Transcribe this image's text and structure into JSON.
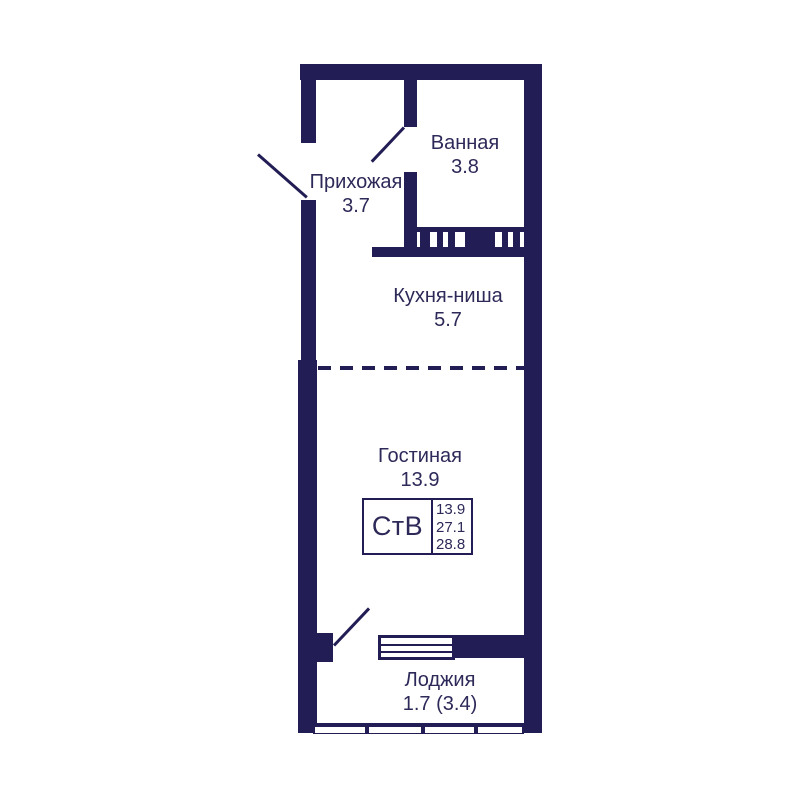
{
  "plan_title": "Studio apartment floor plan",
  "rooms": {
    "bathroom": {
      "label": "Ванная",
      "area": "3.8"
    },
    "hallway": {
      "label": "Прихожая",
      "area": "3.7"
    },
    "kitchen": {
      "label": "Кухня-ниша",
      "area": "5.7"
    },
    "living": {
      "label": "Гостиная",
      "area": "13.9"
    },
    "loggia": {
      "label": "Лоджия",
      "area": "1.7 (3.4)"
    }
  },
  "info_box": {
    "apartment_type": "СтВ",
    "values": [
      "13.9",
      "27.1",
      "28.8"
    ]
  },
  "colors": {
    "wall": "#221d54",
    "text": "#2d2958",
    "background": "#ffffff"
  }
}
